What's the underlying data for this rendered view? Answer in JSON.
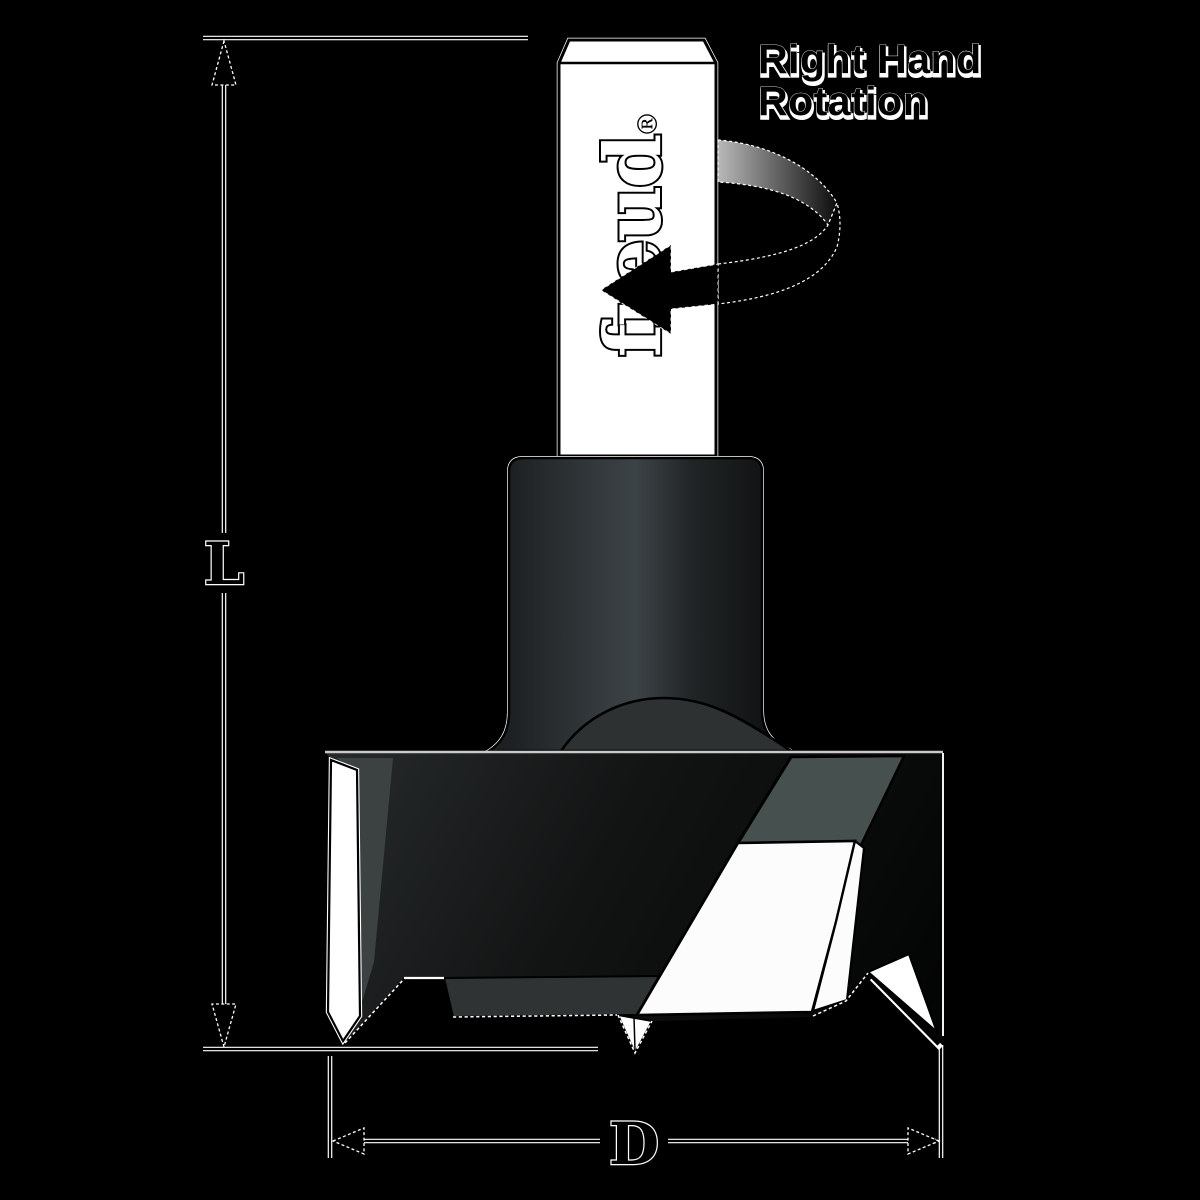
{
  "labels": {
    "rotation_line1": "Right Hand",
    "rotation_line2": "Rotation",
    "brand": "freud",
    "registered": "®",
    "length": "L",
    "diameter": "D"
  },
  "colors": {
    "background": "#000000",
    "shank": "#ffffff",
    "cutter_dark": "#141617",
    "facet_slate": "#46504f",
    "wedge_gray": "#3c4142",
    "land_gray": "#2f3334",
    "insert_white": "#fcfcfc",
    "spur_white": "#ffffff",
    "outline": "#000000",
    "highlight": "#ffffff"
  }
}
